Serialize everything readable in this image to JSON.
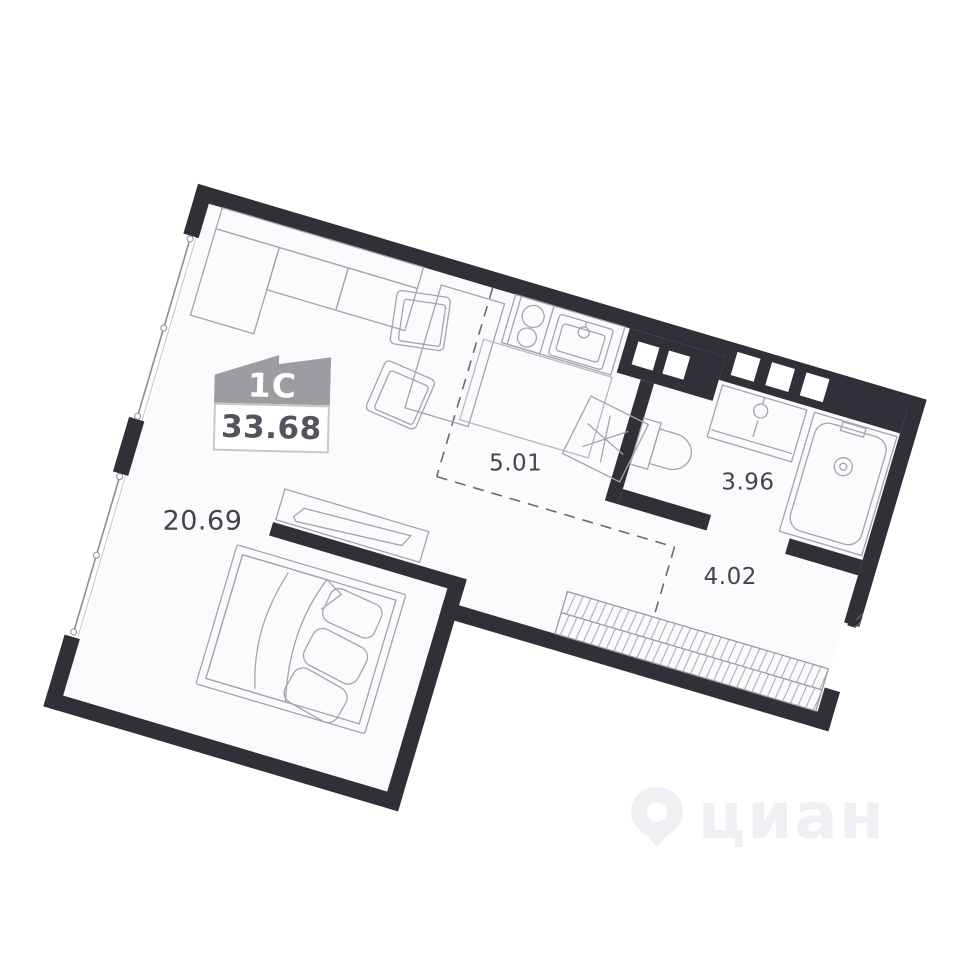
{
  "plan": {
    "type": "studio-apartment-floor-plan",
    "rotation_deg": 16.5,
    "rooms": {
      "living": {
        "name": "living-room",
        "area": "20.69"
      },
      "kitchen": {
        "name": "kitchen-zone",
        "area": "5.01"
      },
      "bathroom": {
        "name": "bathroom",
        "area": "3.96"
      },
      "hallway": {
        "name": "hallway",
        "area": "4.02"
      }
    },
    "symbols": [
      "sofa",
      "dining-table",
      "chair",
      "chair",
      "kitchen-counter",
      "stove",
      "kitchen-sink",
      "fridge",
      "bed",
      "pillows",
      "tv-console",
      "wardrobe-hatch",
      "bath-sink",
      "bathtub",
      "toilet",
      "window",
      "window",
      "entry-door"
    ]
  },
  "badge": {
    "type_label": "1C",
    "area_value": "33.68"
  },
  "watermark": {
    "text": "циан"
  },
  "colors": {
    "wall": "#2f3038",
    "floor": "#fbfbfd",
    "furniture_line": "#a4a4ac",
    "dashed_line": "#6a6a72",
    "label_text": "#44444c",
    "badge_roof": "#9c9ca1",
    "badge_border": "#c7c7cc",
    "watermark": "#eff0f3"
  }
}
